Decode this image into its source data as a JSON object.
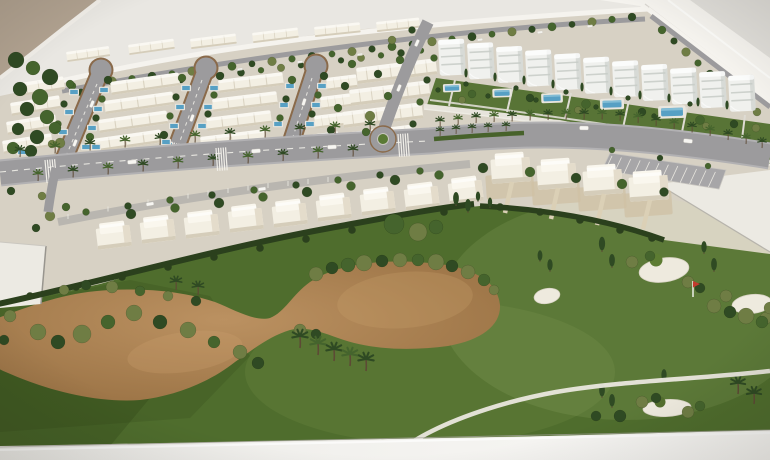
{
  "meta": {
    "title": "Architectural scale model — resort masterplan with golf course",
    "media_type": "photograph",
    "description": "Oblique aerial photograph of a white tabletop architectural model of a residential masterplan: rows of white houses along three looping cul-de-sac streets at upper left, a curved row of white apartment blocks with communal garden pools at upper right, a palm-lined avenue with a roundabout, a front row of detached white villas behind a dark hedge, two blank white future-phase parcels, and a large model golf course with green turf, a sandy waste area, white sand bunkers, a red pin flag, cart paths, palms and shrubs. The model sits on a white base table; a tan wall corner is visible at top left."
  },
  "scene": {
    "setting": "tabletop architectural model photographed at an oblique angle",
    "regions": [
      {
        "name": "wall-corner",
        "label": "Tan wall corner behind the model"
      },
      {
        "name": "table-surface",
        "label": "White table surface around the model"
      },
      {
        "name": "perimeter-edge",
        "label": "Tree-lined perimeter road along the model's top edge"
      },
      {
        "name": "residential-district",
        "label": "Row-house grid on three cul-de-sac streets with small pools"
      },
      {
        "name": "terraced-houses",
        "label": "Terraced house rows beside the third street"
      },
      {
        "name": "apartment-district",
        "label": "Curved row of white apartment blocks with garden and pools"
      },
      {
        "name": "main-avenue",
        "label": "Palm-lined avenue with roundabout, median palms and parking"
      },
      {
        "name": "villa-row",
        "label": "Front row of detached villas facing the golf course"
      },
      {
        "name": "vacant-parcels",
        "label": "Two blank white parcels (future phases)"
      },
      {
        "name": "golf-course",
        "label": "Golf course with waste area, bunkers, cart path and flag"
      },
      {
        "name": "model-front-base",
        "label": "White front fascia of the model base"
      }
    ],
    "counts": {
      "cul_de_sac_streets": 3,
      "apartment_blocks": 11,
      "front_villas": 13,
      "apartment_garden_pools": 5,
      "residential_pools": 22,
      "sand_bunkers": 4,
      "golf_flags": 1,
      "roundabouts": 1
    }
  },
  "palette": {
    "bg-tan": "#b2a391",
    "table": "#e9e7e2",
    "table-bright": "#f5f3ee",
    "table-shade": "#e1dfda",
    "ground": "#d7d1c4",
    "road": "#9c9b9d",
    "road-light": "#b2b1b3",
    "curb": "#8a6a4a",
    "walk": "#dedbd3",
    "house": "#f3efe3",
    "house-sh": "#d5cdba",
    "apt": "#f0f1ee",
    "apt-sh": "#c7ccc7",
    "grass": "#4f6d2d",
    "grass-dark": "#3f5a24",
    "grass-light": "#6b8a3c",
    "hedge": "#2b401d",
    "tree-dark": "#2f4a23",
    "tree-green": "#45642d",
    "tree-olive": "#6f7d44",
    "trunk": "#5d4a35",
    "sand": "#a87c4e",
    "sand-light": "#bb9161",
    "bunker": "#eeeade",
    "pool": "#57a0c4",
    "pool-rim": "#e9e6de",
    "path": "#eae7de",
    "flag-red": "#c43a2e",
    "base": "#f3f2ef",
    "car": "#f7f6f2"
  }
}
